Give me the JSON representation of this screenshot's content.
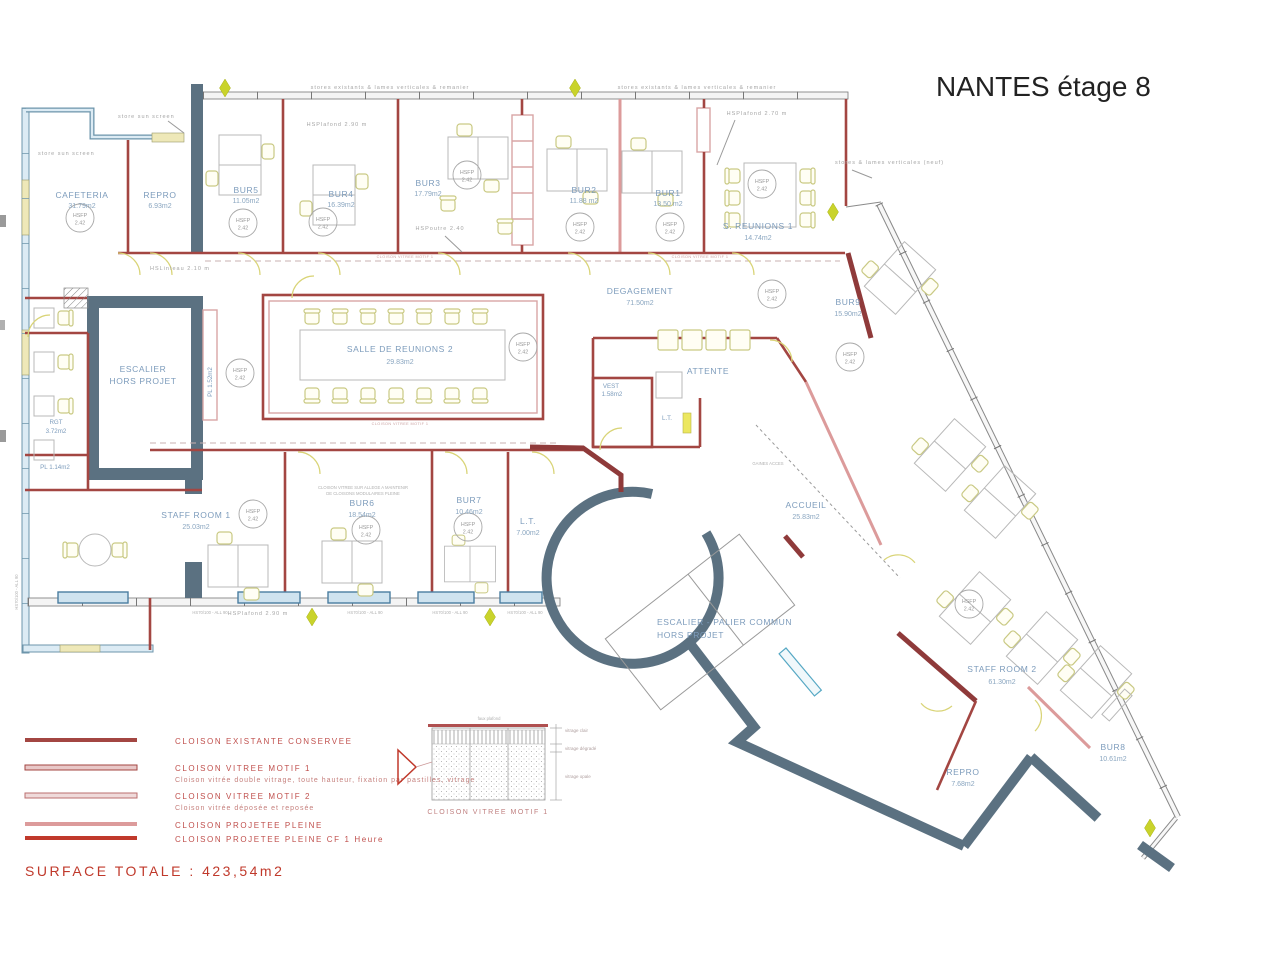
{
  "title": "NANTES étage 8",
  "hsfp": {
    "label": "HSFP",
    "value": "2.42"
  },
  "rooms": [
    {
      "name": "CAFETERIA",
      "area": "31.79m2"
    },
    {
      "name": "REPRO",
      "area": "6.93m2"
    },
    {
      "name": "BUR5",
      "area": "11.05m2"
    },
    {
      "name": "BUR4",
      "area": "16.39m2"
    },
    {
      "name": "BUR3",
      "area": "17.79m2"
    },
    {
      "name": "BUR2",
      "area": "11.88 m2"
    },
    {
      "name": "BUR1",
      "area": "13.50 m2"
    },
    {
      "name": "S. REUNIONS 1",
      "area": "14.74m2"
    },
    {
      "name": "BUR9",
      "area": "15.90m2"
    },
    {
      "name": "DEGAGEMENT",
      "area": "71.50m2"
    },
    {
      "name": "SALLE DE REUNIONS 2",
      "area": "29.83m2"
    },
    {
      "name": "VEST",
      "area": "1.58m2"
    },
    {
      "name": "ATTENTE",
      "area": ""
    },
    {
      "name": "L.T.",
      "area": ""
    },
    {
      "name": "ESCALIER",
      "name2": "HORS PROJET"
    },
    {
      "name": "RGT",
      "area": "3.72m2"
    },
    {
      "name": "PL 1.14m2",
      "area": ""
    },
    {
      "name": "PL 1.52m2",
      "area": ""
    },
    {
      "name": "STAFF ROOM 1",
      "area": "25.03m2"
    },
    {
      "name": "BUR6",
      "area": "18.54m2"
    },
    {
      "name": "BUR7",
      "area": "10.46m2"
    },
    {
      "name": "L.T.",
      "area": "7.00m2"
    },
    {
      "name": "ACCUEIL",
      "area": "25.83m2"
    },
    {
      "name": "ESCALIER - PALIER COMMUN",
      "name2": "HORS PROJET"
    },
    {
      "name": "STAFF ROOM 2",
      "area": "61.30m2"
    },
    {
      "name": "REPRO",
      "area": "7.68m2"
    },
    {
      "name": "BUR8",
      "area": "10.61m2"
    }
  ],
  "annotations": {
    "stores_existants": "stores existants & lames verticales & remanier",
    "stores_neuf": "stores & lames verticales (neuf)",
    "store_sun_screen": "store sun screen",
    "hsplafond_290": "HSPlafond 2.90 m",
    "hsplafond_270": "HSPlafond 2.70 m",
    "hspoutre": "HSPoutre 2.40",
    "hslinteau": "HSLinteau 2.10 m",
    "gaines": "GAINES ACCES",
    "hs_window": "HS70/100 - ALL 90",
    "note1": "CLOISON VITREE SUR ALLEGE A MAINTENIR",
    "note2": "DE CLOISONS MODULAIRES PLEINE",
    "wall_tag": "CLOISON VITREE MOTIF 1"
  },
  "legend": {
    "items": [
      {
        "label": "CLOISON EXISTANTE CONSERVEE",
        "caption": ""
      },
      {
        "label": "CLOISON VITREE MOTIF 1",
        "caption": "Cloison vitrée double vitrage, toute hauteur, fixation par pastilles, vitrage"
      },
      {
        "label": "CLOISON VITREE MOTIF 2",
        "caption": "Cloison vitrée déposée et reposée"
      },
      {
        "label": "CLOISON PROJETEE PLEINE",
        "caption": ""
      },
      {
        "label": "CLOISON PROJETEE PLEINE CF 1 Heure",
        "caption": ""
      }
    ],
    "surface_total": "SURFACE TOTALE : 423,54m2"
  },
  "detail": {
    "caption": "CLOISON VITREE MOTIF 1",
    "top_label": "faux plafond",
    "label_clair": "vitrage clair",
    "label_degrade": "vitrage dégradé",
    "label_opale": "vitrage opale"
  }
}
